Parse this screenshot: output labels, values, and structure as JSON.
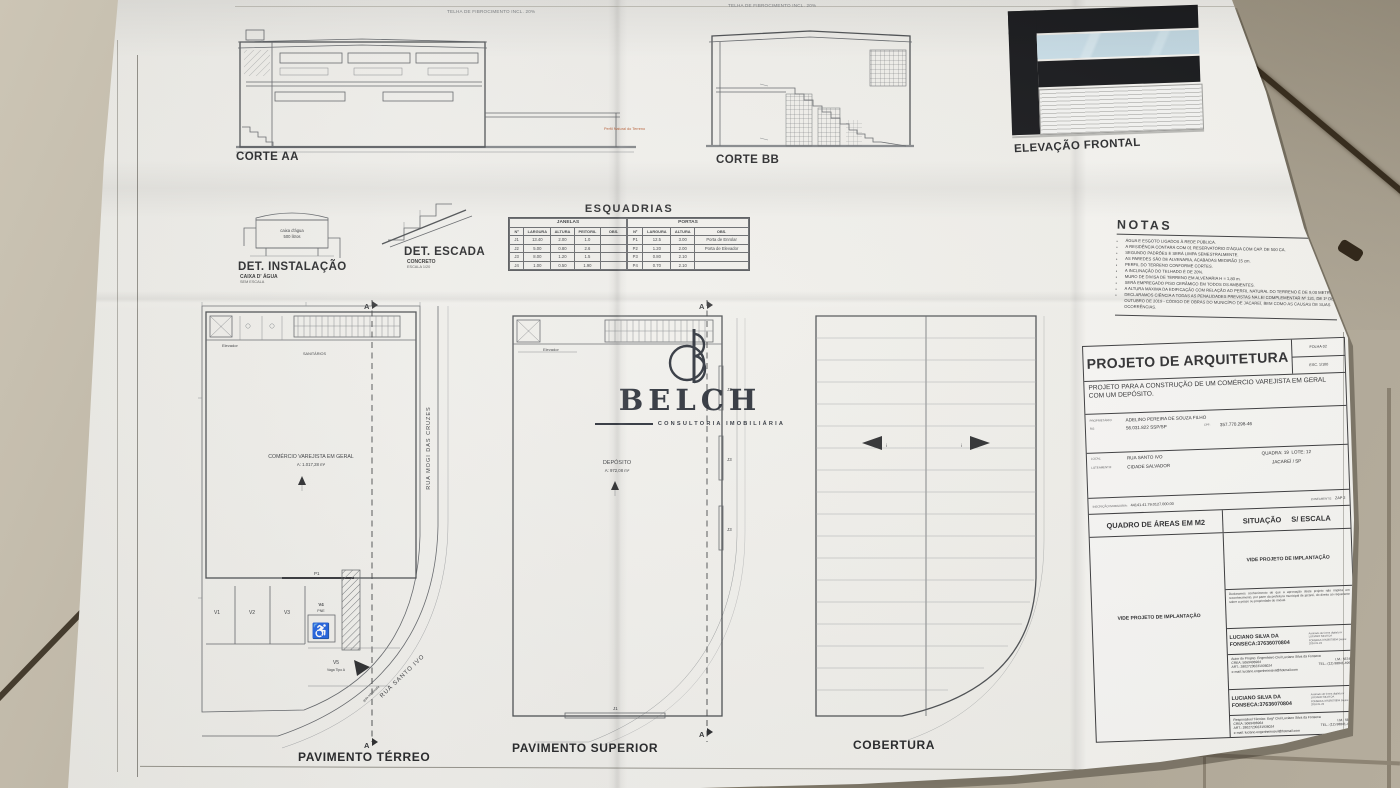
{
  "scene": {
    "floor_color": "#b5ad9d",
    "paper_color": "#f2f1ec",
    "line_color": "#63666a",
    "accent_red": "#b65c33",
    "elevation_glass": "#c2d8e2",
    "elevation_band": "#16171a"
  },
  "watermark": {
    "initial": "B",
    "brand": "BELCH",
    "tagline": "CONSULTORIA IMOBILIÁRIA"
  },
  "cortes": {
    "roof_note_aa": "TELHA DE FIBROCIMENTO INCL. 20%",
    "roof_note_bb": "TELHA DE FIBROCIMENTO INCL. 20%",
    "terrain_note": "Perfil Natural do Terreno",
    "corte_aa_label": "CORTE AA",
    "corte_bb_label": "CORTE BB",
    "elevacao_label": "ELEVAÇÃO FRONTAL"
  },
  "detalhes": {
    "instalacao_label": "DET. INSTALAÇÃO",
    "instalacao_sub1": "CAIXA D' ÁGUA",
    "instalacao_sub2": "SEM ESCALA",
    "tank_line1": "caixa d'água",
    "tank_line2": "500 litros",
    "escada_label": "DET. ESCADA",
    "escada_sub1": "CONCRETO",
    "escada_sub2": "ESCALA 1/20"
  },
  "esquadrias": {
    "title": "ESQUADRIAS",
    "janelas": {
      "group": "JANELAS",
      "headers": [
        "Nº",
        "LARGURA",
        "ALTURA",
        "PEITORIL",
        "OBS."
      ],
      "rows": [
        [
          "J1",
          "13.40",
          "2.00",
          "1.0",
          ""
        ],
        [
          "J2",
          "5.00",
          "0.80",
          "2.6",
          ""
        ],
        [
          "J3",
          "8.00",
          "1.20",
          "1.5",
          ""
        ],
        [
          "J4",
          "1.00",
          "0.50",
          "1.90",
          ""
        ]
      ]
    },
    "portas": {
      "group": "PORTAS",
      "headers": [
        "Nº",
        "LARGURA",
        "ALTURA",
        "OBS."
      ],
      "rows": [
        [
          "P1",
          "12.5",
          "3.00",
          "Porta de Enrolar"
        ],
        [
          "P2",
          "1.20",
          "2.00",
          "Porta de Elevador"
        ],
        [
          "P3",
          "0.80",
          "2.10",
          ""
        ],
        [
          "P4",
          "0.70",
          "2.10",
          ""
        ]
      ]
    }
  },
  "notas": {
    "title": "NOTAS",
    "items": [
      "ÁGUA E ESGOTO LIGADOS À REDE PÚBLICA.",
      "A RESIDÊNCIA CONTARÁ COM 01 RESERVATÓRIO D'ÁGUA COM CAP. DE 500 CA.",
      "SEGUNDO PADRÕES E SERÁ LIMPA SEMESTRALMENTE.",
      "AS PAREDES SÃO DE ALVENARIA, ACABADAS MEDIRÃO 15 cm.",
      "PERFIL DO TERRENO CONFORME CORTES.",
      "A INCLINAÇÃO DO TELHADO É DE 20%.",
      "MURO DE DIVISA DE TERRENO EM ALVENARIA H = 1,80 m.",
      "SERÁ EMPREGADO PISO CERÂMICO EM TODOS OS AMBIENTES.",
      "A ALTURA MÁXIMA DA EDIFICAÇÃO COM RELAÇÃO AO PERFIL NATURAL DO TERRENO É DE 9,00 METROS.",
      "DECLARAMOS CIÊNCIA A TODAS AS PENALIDADES PREVISTAS NA LEI COMPLEMENTAR Nº 131, DE 1º DE OUTUBRO DE 2019 - CÓDIGO DE OBRAS DO MUNICÍPIO DE JACAREÍ, BEM COMO AS CAUSAS DE SUAS OCORRÊNCIAS."
    ]
  },
  "plantas": {
    "terreo": {
      "label": "PAVIMENTO TÉRREO",
      "room": "COMÉRCIO VAREJISTA EM GERAL",
      "area": "A: 1.017,28 m²",
      "elevador": "Elevador",
      "sanitarios": "SANITÁRIOS",
      "street_right": "RUA MOGI DAS CRUZES",
      "street_corner": "RUA SANTO IVO",
      "guia": "guia rebaixada",
      "v1": "V1",
      "v2": "V2",
      "v3": "V3",
      "v4": "V4",
      "pne": "PNE",
      "v5": "V5",
      "v5_sub": "Vaga Tipo A",
      "door": "P1",
      "marker": "A"
    },
    "superior": {
      "label": "PAVIMENTO SUPERIOR",
      "room": "DEPÓSITO",
      "area": "A: 972,08 m²",
      "elevador": "Elevador",
      "j3": "J3",
      "j1": "J1",
      "marker": "A"
    },
    "cobertura": {
      "label": "COBERTURA",
      "slope": "i"
    }
  },
  "titleblock": {
    "title": "PROJETO DE ARQUITETURA",
    "folha_label": "FOLHA",
    "folha": "02",
    "esc_label": "ESC.",
    "esc": "1/100",
    "descricao": "PROJETO PARA A CONSTRUÇÃO DE UM COMÉRCIO VAREJISTA EM GERAL COM UM DEPÓSITO.",
    "proprietario_label": "PROPRIETÁRIO:",
    "proprietario": "ADELINO PEREIRA DE SOUZA FILHO",
    "rg_label": "RG:",
    "rg": "56.031.822 SSP/SP",
    "cpf_label": "CPF:",
    "cpf": "357.770.298-46",
    "local_label": "LOCAL:",
    "local": "RUA SANTO IVO",
    "loteamento_label": "LOTEAMENTO:",
    "loteamento": "CIDADE SALVADOR",
    "quadra": "QUADRA: 19",
    "lote": "LOTE: 12",
    "cidade": "JACAREÍ / SP",
    "inscricao_label": "INSCRIÇÃO IMOBILIÁRIA:",
    "inscricao": "44141.41.79.0127.000.00",
    "zoneamento_label": "ZONEAMENTO:",
    "zoneamento": "ZAP 2",
    "quadro": "QUADRO DE ÁREAS EM M2",
    "situacao": "SITUAÇÃO",
    "situacao_val": "S/ ESCALA",
    "vide": "VIDE PROJETO DE IMPLANTAÇÃO",
    "declaracao": "Declaramos conhecimento de que a aprovação deste projeto não implica em reconhecimento, por parte da prefeitura municipal de jacareí, do direito ao requerente sobre a posse ou propriedade do imóvel.",
    "assinatura": "LUCIANO SILVA DA FONSECA:37636070804",
    "assinatura_info": "Assinado de forma digital por LUCIANO SILVA DA FONSECA:37636070804 Dados: 2024.01.23",
    "autor_titulo": "Autor do Projeto: Engenheiro Civil Luciano Silva da Fonseca",
    "resp_titulo": "Responsável Técnico: Engº Civil Luciano Silva da Fonseca",
    "crea": "CREA: 5069406964",
    "im": "I.M.: 56746",
    "art": "ART.: 28027230231936024",
    "tel": "TEL.: (12) 98841-4993",
    "email": "e-mail: luciano.engenheirocivil@hotmail.com"
  }
}
